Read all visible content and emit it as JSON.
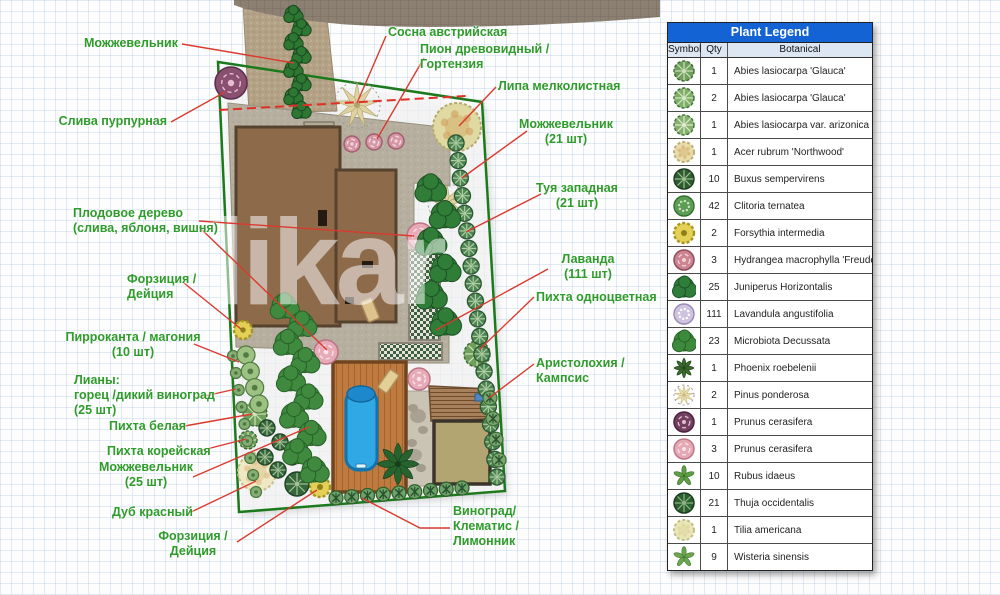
{
  "watermark": "likar",
  "legend": {
    "title": "Plant Legend",
    "columns": [
      "Symbol",
      "Qty",
      "Botanical"
    ],
    "rows": [
      {
        "qty": "1",
        "botanical": "Abies lasiocarpa 'Glauca'",
        "glyph": "conifer",
        "f": "#6f9f5c",
        "s": "#39682f",
        "a": "#cfe2bb"
      },
      {
        "qty": "2",
        "botanical": "Abies lasiocarpa 'Glauca'",
        "glyph": "conifer",
        "f": "#7fae68",
        "s": "#3a6b33",
        "a": "#d8e8c6"
      },
      {
        "qty": "1",
        "botanical": "Abies lasiocarpa var. arizonica",
        "glyph": "conifer",
        "f": "#86b06e",
        "s": "#3f6f36",
        "a": "#e0ecd0"
      },
      {
        "qty": "1",
        "botanical": "Acer rubrum 'Northwood'",
        "glyph": "fluffy",
        "f": "#e8dcab",
        "s": "#bfae74",
        "a": "#d3a765"
      },
      {
        "qty": "10",
        "botanical": "Buxus sempervirens",
        "glyph": "spokes",
        "f": "#2f5b33",
        "s": "#1c3c20",
        "a": "#9fc08f"
      },
      {
        "qty": "42",
        "botanical": "Clitoria ternatea",
        "glyph": "speckle",
        "f": "#5d9e57",
        "s": "#356f2f",
        "a": "#cfe3bd"
      },
      {
        "qty": "2",
        "botanical": "Forsythia intermedia",
        "glyph": "wavy",
        "f": "#e3d157",
        "s": "#a8951d",
        "a": "#8f7e18"
      },
      {
        "qty": "3",
        "botanical": "Hydrangea macrophylla 'Freudenstein'",
        "glyph": "rose",
        "f": "#cb8490",
        "s": "#8e4c5c",
        "a": "#f0d3da"
      },
      {
        "qty": "25",
        "botanical": "Juniperus Horizontalis",
        "glyph": "blob",
        "f": "#2e7d3a",
        "s": "#1d5426",
        "a": "#2e7d3a"
      },
      {
        "qty": "111",
        "botanical": "Lavandula angustifolia",
        "glyph": "speckle",
        "f": "#cfc3df",
        "s": "#988ab6",
        "a": "#ffffff"
      },
      {
        "qty": "23",
        "botanical": "Microbiota Decussata",
        "glyph": "blob",
        "f": "#3e8a3c",
        "s": "#276327",
        "a": "#3e8a3c"
      },
      {
        "qty": "1",
        "botanical": "Phoenix roebelenii",
        "glyph": "palm",
        "f": "#3a6b2d",
        "s": "#23471c",
        "a": "#23471c"
      },
      {
        "qty": "2",
        "botanical": "Pinus ponderosa",
        "glyph": "star",
        "f": "#ece2b4",
        "s": "#c9b97e",
        "a": "#9a8d5c"
      },
      {
        "qty": "1",
        "botanical": "Prunus cerasifera",
        "glyph": "rose",
        "f": "#733f5e",
        "s": "#4b2340",
        "a": "#e3bcd0"
      },
      {
        "qty": "3",
        "botanical": "Prunus cerasifera",
        "glyph": "rose",
        "f": "#e4a9b4",
        "s": "#c17687",
        "a": "#f9e3e8"
      },
      {
        "qty": "10",
        "botanical": "Rubus idaeus",
        "glyph": "leafstar",
        "f": "#5f9e46",
        "s": "#3c6e2b",
        "a": "#3c6e2b"
      },
      {
        "qty": "21",
        "botanical": "Thuja occidentalis",
        "glyph": "spokes",
        "f": "#2c5e30",
        "s": "#19391d",
        "a": "#8fb583"
      },
      {
        "qty": "1",
        "botanical": "Tilia americana",
        "glyph": "fluffy",
        "f": "#e9e6b8",
        "s": "#c2bd84",
        "a": "#d9cf92"
      },
      {
        "qty": "9",
        "botanical": "Wisteria sinensis",
        "glyph": "leafstar",
        "f": "#6aa64e",
        "s": "#457831",
        "a": "#457831"
      }
    ]
  },
  "plan": {
    "labels": [
      {
        "text": "Можжевельник",
        "x": 178,
        "y": 36,
        "align": "right"
      },
      {
        "text": "Слива пурпурная",
        "x": 167,
        "y": 114,
        "align": "right"
      },
      {
        "text": "Сосна австрийская",
        "x": 388,
        "y": 25,
        "align": "left"
      },
      {
        "text": "Пион древовидный /\nГортензия",
        "x": 420,
        "y": 42,
        "align": "left"
      },
      {
        "text": "Липа мелколистная",
        "x": 498,
        "y": 79,
        "align": "left"
      },
      {
        "text": "Можжевельник\n(21 шт)",
        "x": 566,
        "y": 117,
        "align": "center"
      },
      {
        "text": "Туя западная\n(21 шт)",
        "x": 577,
        "y": 181,
        "align": "center"
      },
      {
        "text": "Лаванда\n(111 шт)",
        "x": 588,
        "y": 252,
        "align": "center"
      },
      {
        "text": "Пихта одноцветная",
        "x": 536,
        "y": 290,
        "align": "left"
      },
      {
        "text": "Аристолохия / Кампсис",
        "x": 536,
        "y": 356,
        "align": "left"
      },
      {
        "text": "Плодовое дерево\n(слива, яблоня, вишня)",
        "x": 73,
        "y": 206,
        "align": "left"
      },
      {
        "text": "Форзиция /\nДейция",
        "x": 127,
        "y": 272,
        "align": "left"
      },
      {
        "text": "Пирроканта / магония\n(10 шт)",
        "x": 133,
        "y": 330,
        "align": "center"
      },
      {
        "text": "Лианы:\nгорец /дикий виноград\n(25 шт)",
        "x": 74,
        "y": 373,
        "align": "left"
      },
      {
        "text": "Пихта белая",
        "x": 109,
        "y": 419,
        "align": "left"
      },
      {
        "text": "Пихта корейская",
        "x": 107,
        "y": 444,
        "align": "left"
      },
      {
        "text": "Можжевельник\n(25 шт)",
        "x": 146,
        "y": 460,
        "align": "center"
      },
      {
        "text": "Дуб красный",
        "x": 112,
        "y": 505,
        "align": "left"
      },
      {
        "text": "Форзиция /\nДейция",
        "x": 193,
        "y": 529,
        "align": "center"
      },
      {
        "text": "Виноград/\nКлематис /\nЛимонник",
        "x": 453,
        "y": 504,
        "align": "left"
      }
    ],
    "leaders": [
      {
        "points": [
          [
            182,
            44
          ],
          [
            294,
            63
          ]
        ]
      },
      {
        "points": [
          [
            171,
            122
          ],
          [
            225,
            92
          ]
        ]
      },
      {
        "points": [
          [
            386,
            36
          ],
          [
            357,
            103
          ]
        ]
      },
      {
        "points": [
          [
            424,
            58
          ],
          [
            377,
            139
          ]
        ]
      },
      {
        "points": [
          [
            496,
            87
          ],
          [
            459,
            126
          ]
        ]
      },
      {
        "points": [
          [
            527,
            131
          ],
          [
            462,
            178
          ]
        ]
      },
      {
        "points": [
          [
            541,
            194
          ],
          [
            466,
            232
          ]
        ]
      },
      {
        "points": [
          [
            548,
            269
          ],
          [
            436,
            330
          ]
        ]
      },
      {
        "points": [
          [
            534,
            297
          ],
          [
            480,
            349
          ]
        ]
      },
      {
        "points": [
          [
            534,
            364
          ],
          [
            489,
            398
          ]
        ]
      },
      {
        "points": [
          [
            199,
            221
          ],
          [
            414,
            236
          ]
        ]
      },
      {
        "points": [
          [
            199,
            227
          ],
          [
            327,
            350
          ]
        ]
      },
      {
        "points": [
          [
            184,
            283
          ],
          [
            241,
            329
          ]
        ]
      },
      {
        "points": [
          [
            194,
            344
          ],
          [
            239,
            362
          ]
        ]
      },
      {
        "points": [
          [
            196,
            398
          ],
          [
            236,
            389
          ]
        ]
      },
      {
        "points": [
          [
            179,
            427
          ],
          [
            252,
            414
          ]
        ]
      },
      {
        "points": [
          [
            199,
            451
          ],
          [
            246,
            439
          ]
        ]
      },
      {
        "points": [
          [
            193,
            477
          ],
          [
            309,
            427
          ]
        ]
      },
      {
        "points": [
          [
            187,
            514
          ],
          [
            256,
            481
          ]
        ]
      },
      {
        "points": [
          [
            237,
            542
          ],
          [
            317,
            490
          ]
        ]
      },
      {
        "points": [
          [
            450,
            528
          ],
          [
            420,
            528
          ],
          [
            362,
            498
          ]
        ]
      }
    ],
    "dashed_line": {
      "points": [
        [
          219,
          110
        ],
        [
          466,
          96
        ]
      ]
    },
    "plants": [
      {
        "t": "rose",
        "x": 231,
        "y": 83,
        "r": 16,
        "f": "#8a5070",
        "s": "#5a2e4d",
        "a": "#e7bed2"
      },
      {
        "t": "star",
        "x": 357,
        "y": 105,
        "r": 23,
        "f": "#ded2a2",
        "s": "#b1a26b",
        "a": "#8b7f4f"
      },
      {
        "t": "star",
        "x": 447,
        "y": 203,
        "r": 19,
        "f": "#ded2a2",
        "s": "#b1a26b",
        "a": "#8b7f4f"
      },
      {
        "t": "fluffy",
        "x": 457,
        "y": 127,
        "r": 24,
        "f": "#e0d9a2",
        "s": "#b4ab6e",
        "a": "#cf9a55"
      },
      {
        "t": "fluffy",
        "x": 257,
        "y": 472,
        "r": 19,
        "f": "#efe8c4",
        "s": "#c9bd8a",
        "a": "#d8b87e"
      },
      {
        "t": "rose",
        "x": 352,
        "y": 144,
        "r": 8,
        "f": "#d495a4",
        "s": "#a25f70",
        "a": "#f2d6dc"
      },
      {
        "t": "rose",
        "x": 374,
        "y": 142,
        "r": 8,
        "f": "#d495a4",
        "s": "#a25f70",
        "a": "#f2d6dc"
      },
      {
        "t": "rose",
        "x": 396,
        "y": 141,
        "r": 8,
        "f": "#d495a4",
        "s": "#a25f70",
        "a": "#f2d6dc"
      },
      {
        "t": "rose",
        "x": 420,
        "y": 236,
        "r": 13,
        "f": "#e6abb7",
        "s": "#bc7386",
        "a": "#f9e3e8"
      },
      {
        "t": "rose",
        "x": 326,
        "y": 352,
        "r": 12,
        "f": "#e6abb7",
        "s": "#bc7386",
        "a": "#f9e3e8"
      },
      {
        "t": "rose",
        "x": 419,
        "y": 379,
        "r": 11,
        "f": "#e6abb7",
        "s": "#bc7386",
        "a": "#f9e3e8"
      },
      {
        "t": "conifer",
        "x": 477,
        "y": 354,
        "r": 13,
        "f": "#6f9f5c",
        "s": "#39682f",
        "a": "#cfe2bb"
      },
      {
        "t": "conifer",
        "x": 255,
        "y": 414,
        "r": 12,
        "f": "#6f9f5c",
        "s": "#39682f",
        "a": "#cfe2bb"
      },
      {
        "t": "conifer",
        "x": 248,
        "y": 440,
        "r": 9,
        "f": "#6f9f5c",
        "s": "#39682f",
        "a": "#cfe2bb"
      },
      {
        "t": "wavy",
        "x": 243,
        "y": 330,
        "r": 9,
        "f": "#e3d157",
        "s": "#a8951d",
        "a": "#8f7e18"
      },
      {
        "t": "wavy",
        "x": 320,
        "y": 487,
        "r": 10,
        "f": "#e3d157",
        "s": "#a8951d",
        "a": "#8f7e18"
      },
      {
        "t": "palm",
        "x": 398,
        "y": 464,
        "r": 21,
        "f": "#26632e",
        "s": "#163e1a",
        "a": "#163e1a"
      },
      {
        "t": "spokes",
        "x": 267,
        "y": 428,
        "r": 8,
        "f": "#36663c",
        "s": "#1f4426",
        "a": "#a3c295"
      },
      {
        "t": "spokes",
        "x": 280,
        "y": 442,
        "r": 8,
        "f": "#36663c",
        "s": "#1f4426",
        "a": "#a3c295"
      },
      {
        "t": "spokes",
        "x": 265,
        "y": 457,
        "r": 8,
        "f": "#36663c",
        "s": "#1f4426",
        "a": "#a3c295"
      },
      {
        "t": "spokes",
        "x": 278,
        "y": 470,
        "r": 8,
        "f": "#36663c",
        "s": "#1f4426",
        "a": "#a3c295"
      },
      {
        "t": "spokes",
        "x": 292,
        "y": 457,
        "r": 8,
        "f": "#36663c",
        "s": "#1f4426",
        "a": "#a3c295"
      },
      {
        "t": "spokes",
        "x": 297,
        "y": 484,
        "r": 12,
        "f": "#36663c",
        "s": "#1f4426",
        "a": "#a3c295"
      },
      {
        "row": true,
        "from": [
          456,
          143
        ],
        "to": [
          497,
          477
        ],
        "n": 20,
        "r": 8,
        "t": "spokes",
        "f": "#4f8454",
        "s": "#2b5a30",
        "a": "#aecfa2"
      },
      {
        "row": true,
        "from": [
          336,
          498
        ],
        "to": [
          462,
          488
        ],
        "n": 9,
        "r": 7,
        "t": "xcircle",
        "f": "#6ea268",
        "s": "#2f5f2b",
        "a": "#27512f"
      },
      {
        "row": true,
        "from": [
          233,
          356
        ],
        "to": [
          256,
          492
        ],
        "n": 9,
        "r": 5.5,
        "t": "dot",
        "f": "#86ad74",
        "s": "#49793f",
        "a": "#49793f"
      },
      {
        "row": true,
        "from": [
          246,
          355
        ],
        "to": [
          259,
          404
        ],
        "n": 4,
        "r": 9,
        "t": "dot",
        "f": "#9cc183",
        "s": "#517b41",
        "a": "#3f6b33"
      },
      {
        "row": true,
        "from": [
          490,
          398
        ],
        "to": [
          499,
          460
        ],
        "n": 4,
        "r": 7,
        "t": "xcircle",
        "f": "#79a771",
        "s": "#3a6a33",
        "a": "#2c5429"
      },
      {
        "row": true,
        "from": [
          297,
          14
        ],
        "to": [
          297,
          110
        ],
        "n": 8,
        "r": 8,
        "t": "blob",
        "f": "#2d7733",
        "s": "#1b4a20",
        "a": "#2d7733",
        "wobble": 4
      },
      {
        "row": true,
        "from": [
          437,
          188
        ],
        "to": [
          438,
          322
        ],
        "n": 6,
        "r": 13,
        "t": "blob",
        "f": "#2f7d37",
        "s": "#1d5124",
        "a": "#2f7d37",
        "wobble": 7
      },
      {
        "row": true,
        "from": [
          292,
          306
        ],
        "to": [
          306,
          470
        ],
        "n": 10,
        "r": 12,
        "t": "blob",
        "f": "#3f8a3f",
        "s": "#276127",
        "a": "#3f8a3f",
        "wobble": 8
      }
    ]
  }
}
